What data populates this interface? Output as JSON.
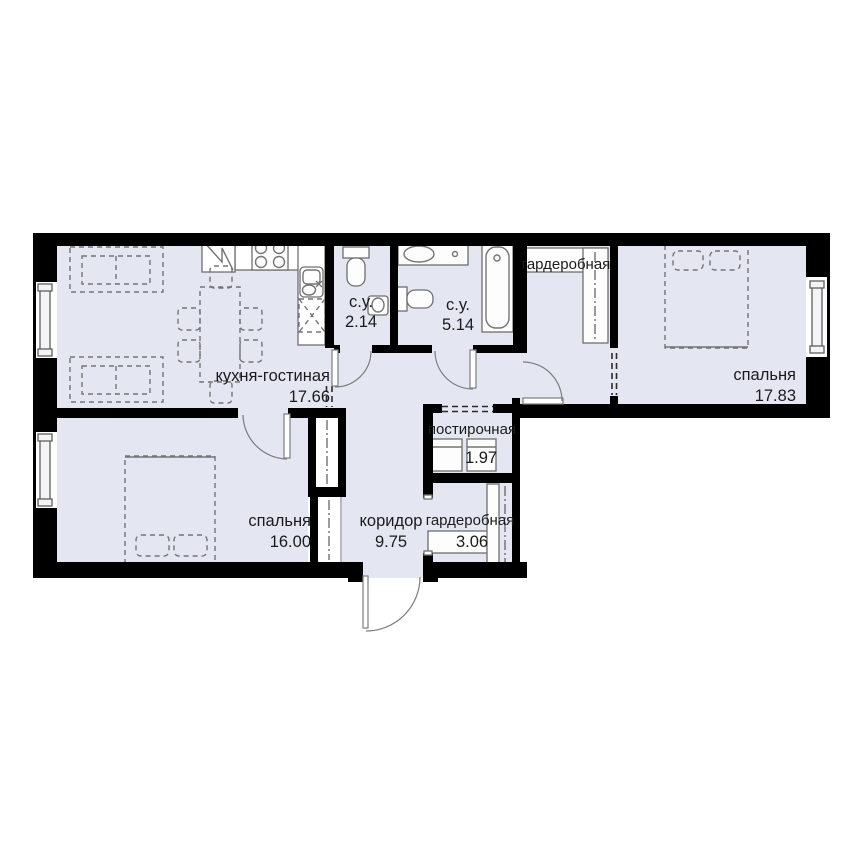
{
  "plan": {
    "rooms": [
      {
        "id": "kitchen-living",
        "label": "кухня-гостиная",
        "area": "17.66"
      },
      {
        "id": "bathroom-small",
        "label": "с.у.",
        "area": "2.14"
      },
      {
        "id": "bathroom-large",
        "label": "с.у.",
        "area": "5.14"
      },
      {
        "id": "wardrobe-top",
        "label": "гардеробная",
        "area": ""
      },
      {
        "id": "bedroom-right",
        "label": "спальня",
        "area": "17.83"
      },
      {
        "id": "bedroom-left",
        "label": "спальня",
        "area": "16.00"
      },
      {
        "id": "corridor",
        "label": "коридор",
        "area": "9.75"
      },
      {
        "id": "laundry",
        "label": "постирочная",
        "area": "1.97"
      },
      {
        "id": "wardrobe-bottom",
        "label": "гардеробная",
        "area": "3.06"
      }
    ],
    "colors": {
      "floor": "#e4e6f1",
      "wall": "#000000",
      "furniture_line": "#757575",
      "text": "#1b1b1b",
      "background": "#ffffff"
    }
  }
}
